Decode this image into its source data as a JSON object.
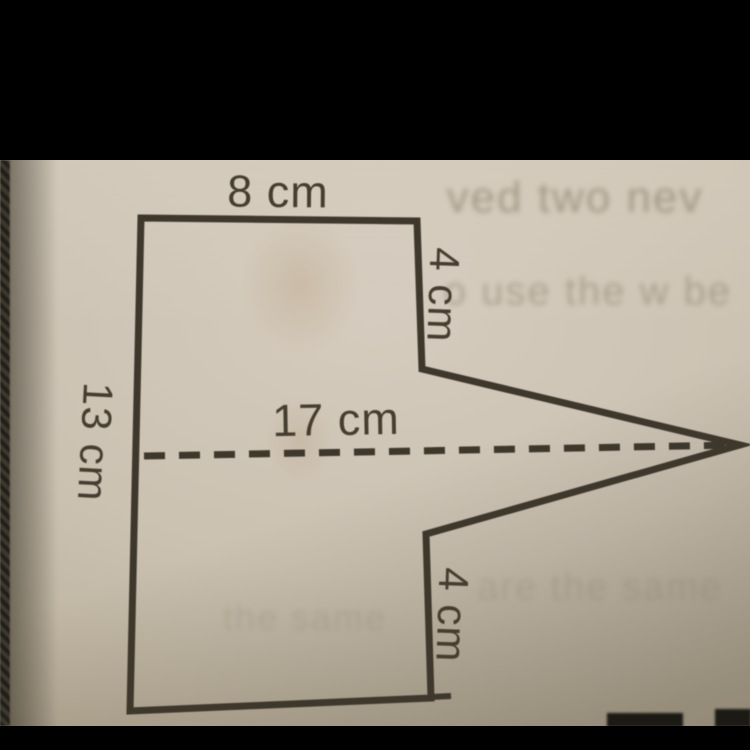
{
  "scene": {
    "description": "Photographed math worksheet showing a composite shape: a rectangle with a triangular point extending to the right, drawn with a dashed midline",
    "paper_color": "#cbc1b1",
    "ink_color": "#3e372c",
    "letterbox_color": "#000000"
  },
  "figure": {
    "shape": "rectangle with triangular notch/point on right side",
    "labels": {
      "top_width": "8 cm",
      "right_upper": "4 cm",
      "left_height": "13 cm",
      "middle_length": "17 cm",
      "right_lower": "4 cm"
    },
    "measurements_cm": {
      "top_width": 8,
      "right_upper_segment": 4,
      "left_height": 13,
      "dashed_midline_length": 17,
      "right_lower_segment": 4
    }
  },
  "ghost_text": {
    "line1": "ved two nev",
    "line2": "o use the w be",
    "line3": "are the same",
    "line4": "the same"
  }
}
